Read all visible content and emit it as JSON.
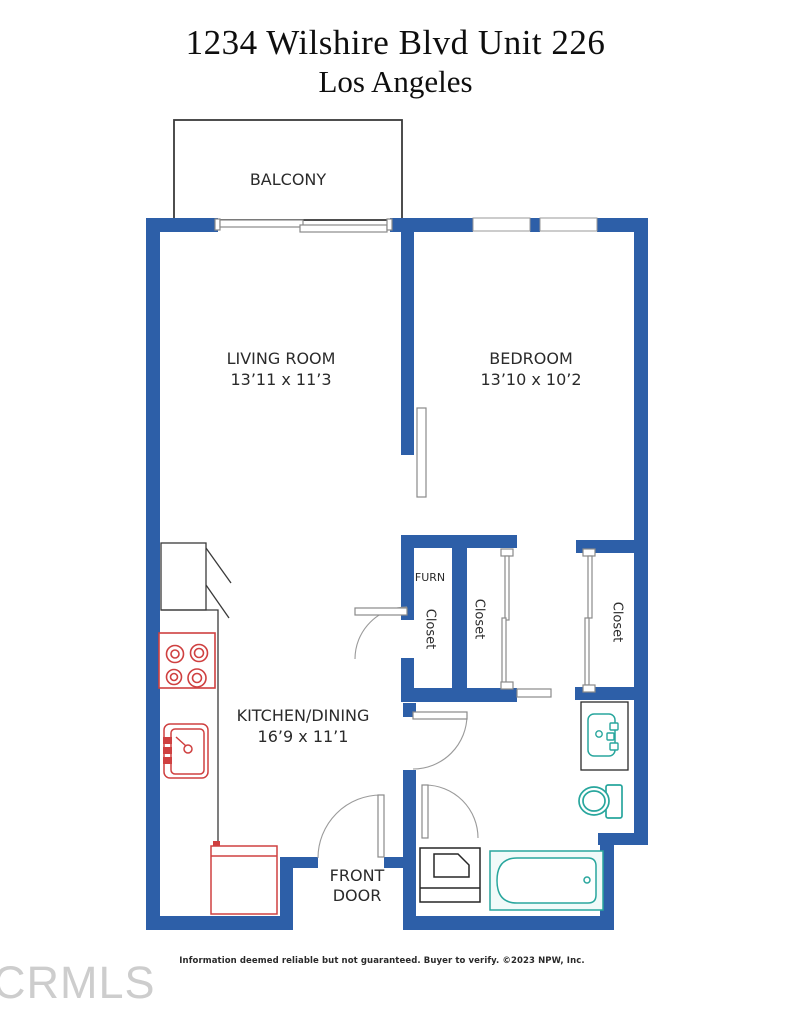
{
  "page": {
    "title_line1": "1234 Wilshire Blvd Unit 226",
    "title_line2": "Los Angeles"
  },
  "rooms": {
    "balcony": {
      "label": "BALCONY"
    },
    "living_room": {
      "label": "LIVING ROOM",
      "dims": "13’11 x 11’3"
    },
    "bedroom": {
      "label": "BEDROOM",
      "dims": "13’10 x 10’2"
    },
    "kitchen_dining": {
      "label": "KITCHEN/DINING",
      "dims": "16’9 x 11’1"
    },
    "furnace_closet": {
      "label": "FURN"
    },
    "hall_closet": {
      "label": "Closet"
    },
    "middle_closet": {
      "label": "Closet"
    },
    "bedroom_closet": {
      "label": "Closet"
    },
    "entry": {
      "label": "FRONT DOOR"
    }
  },
  "footer": {
    "disclaimer": "Information deemed reliable but not guaranteed. Buyer to verify. ©2023 NPW, Inc.",
    "watermark": "CRMLS"
  },
  "colors": {
    "wall_blue": "#2d5fa8",
    "kitchen_red": "#cf4040",
    "bath_teal": "#28a69d"
  }
}
